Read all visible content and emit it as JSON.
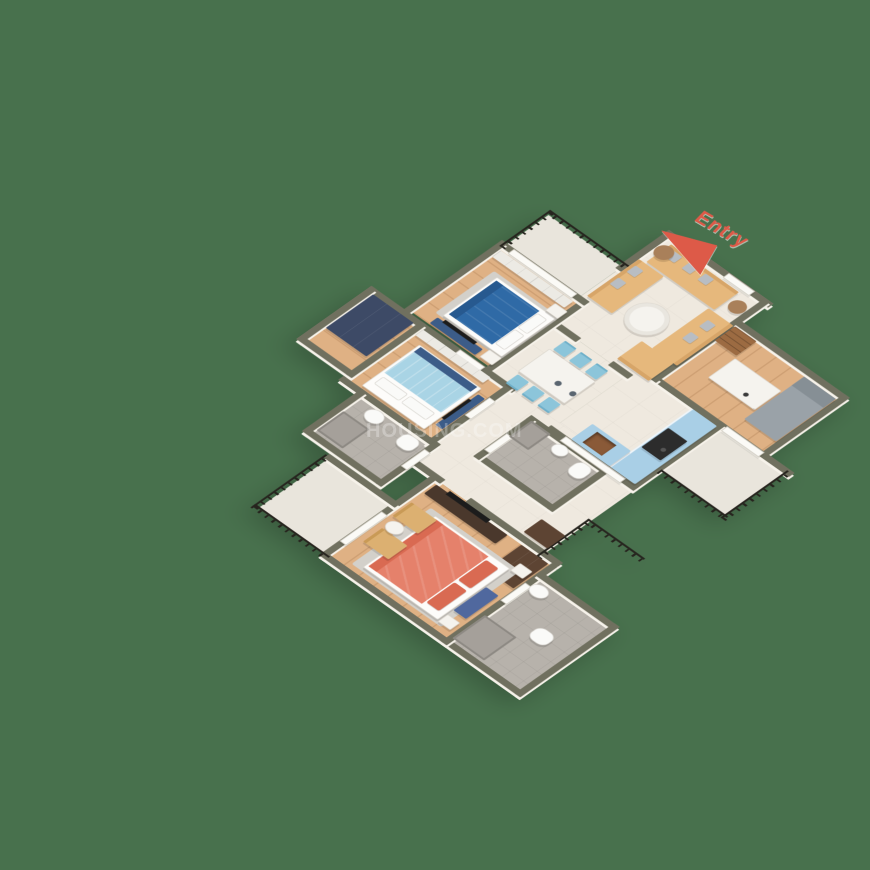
{
  "annotations": {
    "entry_label": "Entry",
    "watermark_text": "HOUSING.COM"
  },
  "palette": {
    "bg": "#48714d",
    "wall": "#70705f",
    "wallFace": "#f6f2ea",
    "cream": "#efe9df",
    "wood": "#dfb184",
    "woodLine": "rgba(120,70,30,0.16)",
    "pale": "#e9e5dc",
    "tile": "#b7b2ab",
    "railing": "#26241e",
    "doorWhite": "#fbfaf6",
    "sofaTan": "#e6b87c",
    "sofaTanDark": "#d7a568",
    "pillowGray": "#b8bdc3",
    "sideWood": "#a9805a",
    "tableWhite": "#f5f3ee",
    "bedBlue": "#2f6aa6",
    "bedBlueDark": "#27598f",
    "bedSky": "#a9d4e5",
    "bedFrame": "#fdfcfa",
    "rug": "#d3d0ca",
    "chairSky": "#8cc5da",
    "cabBlue": "#a9cfe6",
    "stove": "#2c2c2c",
    "sinkBrown": "#8a5a38",
    "navy": "#3d4a66",
    "navyBench": "#3c5c88",
    "tvBlack": "#1c1c1c",
    "consoleDark": "#4a382c",
    "wardBrown": "#5d4433",
    "shelfBrown": "#9c6b42",
    "daybed": "#9aa2a8",
    "daybedDark": "#868f95",
    "chairTan": "#dcb071",
    "ceramic": "#fafaf8",
    "shower": "#a5a09a",
    "benchBlue": "#50689e",
    "accent": "#dd5a48",
    "watermark": "rgba(255,255,255,0.28)"
  },
  "scene": {
    "view": "isometric-3d-floor-plan",
    "rooms": [
      "living-room",
      "dining-area",
      "kitchen",
      "study-room",
      "bedroom-blue",
      "bedroom-sky",
      "master-bedroom",
      "dressing-area",
      "bathroom-common",
      "bathroom-attached",
      "master-bathroom",
      "balcony-top",
      "balcony-right",
      "master-balcony",
      "utility-opening"
    ],
    "furniture": [
      "u-shaped-tan-sofa-set",
      "round-coffee-table",
      "side-tables",
      "dining-table-6-sky-blue-chairs",
      "blue-kitchen-counters",
      "gas-stove",
      "wooden-sink",
      "study-desk",
      "bookshelf",
      "gray-daybed",
      "double-bed-dark-blue",
      "double-bed-sky-blue",
      "double-bed-coral",
      "navy-wardrobes",
      "tv-consoles",
      "tan-armchairs",
      "toilets",
      "showers",
      "black-iron-railings"
    ]
  }
}
